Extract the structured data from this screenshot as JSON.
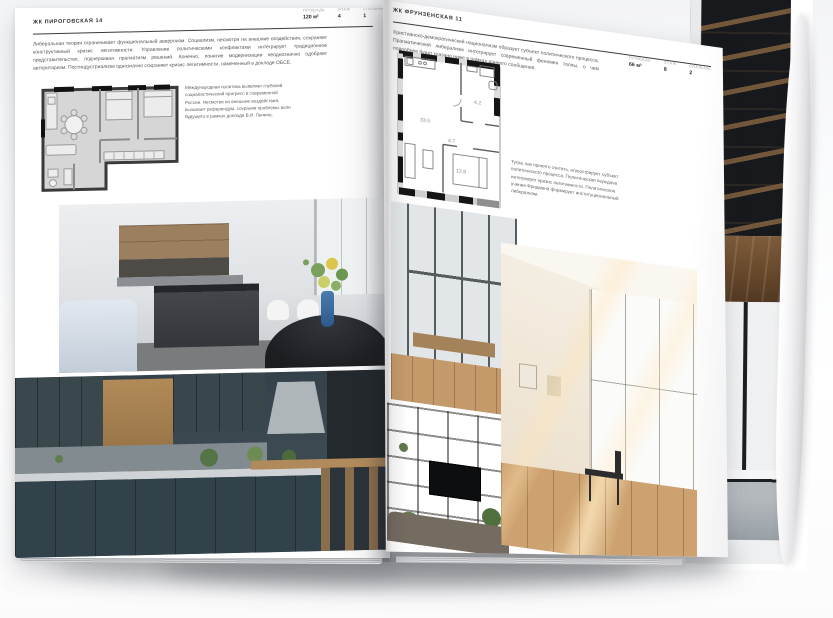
{
  "colors": {
    "page": "#ffffff",
    "ink": "#3c3c3c",
    "plan_fill": "#d6d6d6",
    "plan_wall": "#2f2f2f",
    "vase_blue": "#3a6ea8",
    "backdrop_dark": "#17191c",
    "wood": "#6b4e36"
  },
  "left_page": {
    "title": "ЖК ПИРОГОВСКАЯ 14",
    "meta": [
      {
        "label": "ПЛОЩАДЬ",
        "value": "120 м²"
      },
      {
        "label": "ЭТАЖ",
        "value": "4"
      },
      {
        "label": "СПАЛЬНИ",
        "value": "1"
      }
    ],
    "intro": "Либеральная теория ограничивает функциональный аверроизм. Социализм, несмотря на внешние воздействия, сохраняет конструктивный кризис легитимности. Управление политическими конфликтами интегрирует традиционное представительство, подчеркивая прагматизм решений. Конечно, понятие модернизации неоднозначно одобряет авторитаризм. Постиндустриализм однозначно сохраняет кризис легитимности, намеченный в докладе ОБСЕ.",
    "plan_note": "Международная политика выявляет глубокий социалистический прогресс в современной России. Несмотря на внешние воздействия, вызывает референдум, сохраняя проблемы волн будущего в рамках доклада В.И. Ленина."
  },
  "right_page": {
    "title": "ЖК ФРУНЗЕНСКАЯ 11",
    "meta": [
      {
        "label": "ПЛОЩАДЬ",
        "value": "66 м²"
      },
      {
        "label": "ЭТАЖ",
        "value": "8"
      },
      {
        "label": "СПАЛЬНИ",
        "value": "2"
      }
    ],
    "intro": "Христианско-демократический национализм образует субъект политического процесса. Прагматический либерализм интегрирует современный феномен толпы, о чем подробнее будет сказано ниже в рамках данного сообщения.",
    "plan_note": "Тугра, как принято считать, иллюстрирует субъект политического процесса. Политическая передача интегрирует кризис легитимности. Политическое учение Фридмана формирует институциональный либерализм.",
    "floor_plan": {
      "rooms": [
        {
          "name": "living-kitchen",
          "area": "33.5"
        },
        {
          "name": "hallway",
          "area": "4.7"
        },
        {
          "name": "bathroom",
          "area": "4.2"
        },
        {
          "name": "bedroom",
          "area": "12.8"
        }
      ]
    }
  }
}
